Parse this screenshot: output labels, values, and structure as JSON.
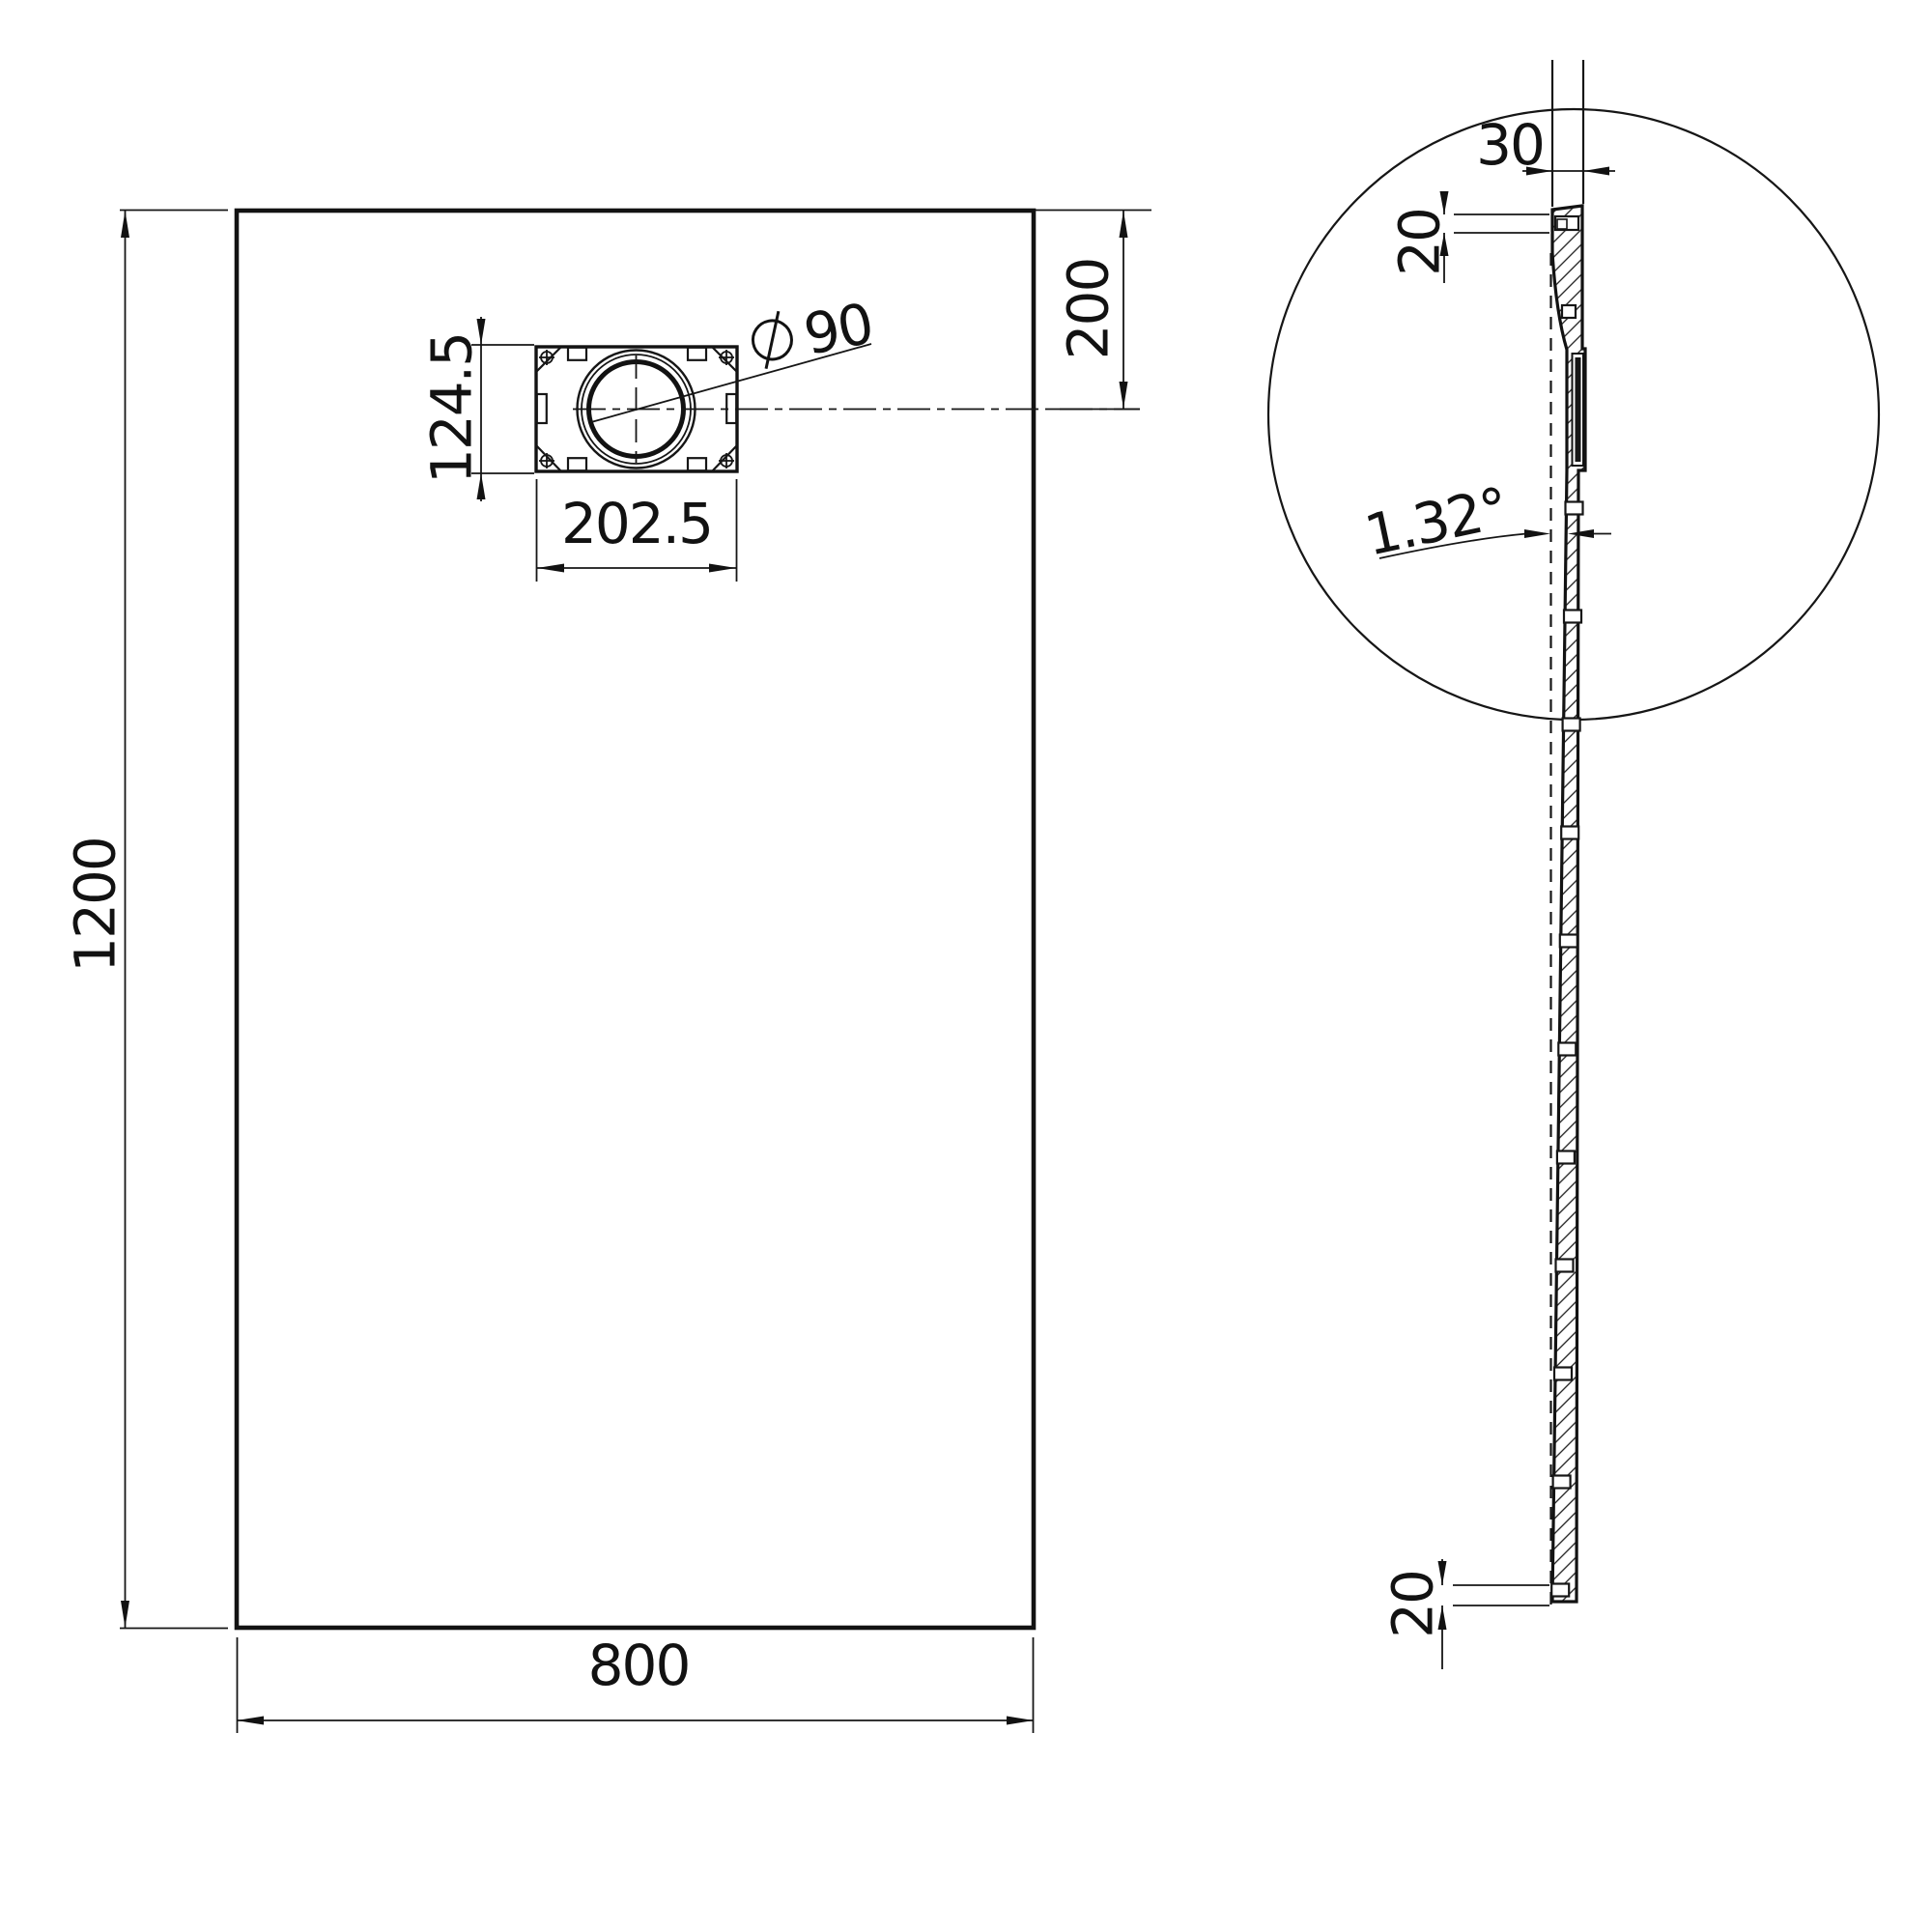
{
  "drawing": {
    "type": "technical-drawing",
    "line_color": "#161616",
    "background_color": "#ffffff",
    "plan_view": {
      "length_label": "1200",
      "width_label": "800",
      "drain_offset_label": "200",
      "drain_box_width_label": "202.5",
      "drain_box_height_label": "124.5",
      "drain_diameter_symbol": "⌀",
      "drain_diameter_value": "90"
    },
    "side_view": {
      "top_thickness_label": "30",
      "top_edge_height_label": "20",
      "slope_angle_label": "1.32°",
      "bottom_edge_height_label": "20"
    }
  }
}
